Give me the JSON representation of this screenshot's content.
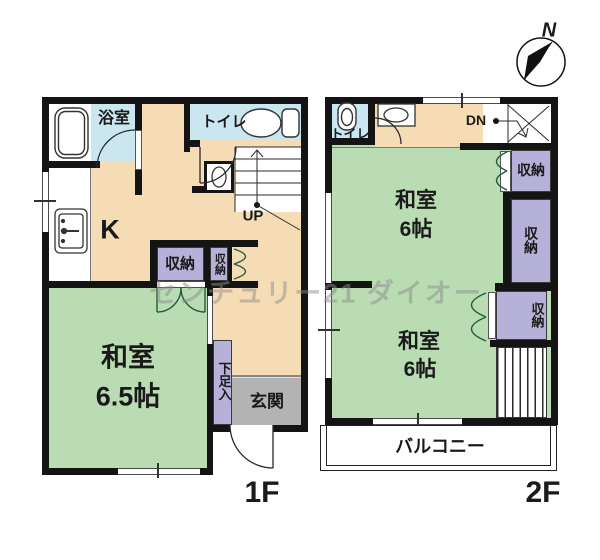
{
  "watermark": "センチュリー21 ダイオー",
  "compass": {
    "north": "N"
  },
  "floor1": {
    "label": "1F",
    "bath": "浴室",
    "toilet": "トイレ",
    "kitchen": "K",
    "stairs_up": "UP",
    "closet_left": "収納",
    "closet_right": "収納",
    "room_name": "和室",
    "room_size": "6.5帖",
    "shoe_cabinet": "下足入",
    "entrance": "玄関"
  },
  "floor2": {
    "label": "2F",
    "toilet": "トイレ",
    "stairs_down": "DN",
    "closet_top": "収納",
    "closet_middle": "収納",
    "closet_bottom": "収納",
    "room1_name": "和室",
    "room1_size": "6帖",
    "room2_name": "和室",
    "room2_size": "6帖",
    "balcony": "バルコニー"
  },
  "colors": {
    "tatami_green": "#b9dcb2",
    "hall_beige": "#f6dcb4",
    "wet_area_blue": "#c9e6f1",
    "closet_purple": "#b5b1d8",
    "entrance_gray": "#b3b3b3",
    "wall_black": "#141414",
    "watermark_gray": "#8f8f8f"
  }
}
